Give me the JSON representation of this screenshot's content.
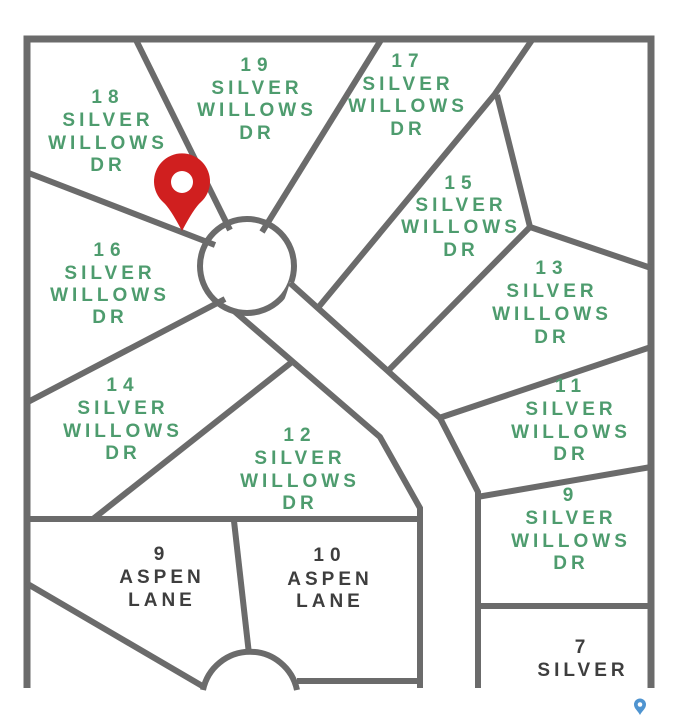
{
  "map": {
    "description_labels": {
      "street_silver_willows": "SILVER WILLOWS DR",
      "street_aspen_lane": "ASPEN LANE"
    },
    "colors": {
      "background": "#ffffff",
      "line": "#6b6b6b",
      "label_green": "#4e9c6e",
      "label_dark": "#3e3e3e",
      "pin_red": "#d01f1f",
      "pin_hole": "#ffffff",
      "mini_pin_blue": "#4f94d0"
    },
    "lots": [
      {
        "number": "18",
        "street": "SILVER WILLOWS DR",
        "lines": [
          "18",
          "SILVER",
          "WILLOWS",
          "DR"
        ]
      },
      {
        "number": "19",
        "street": "SILVER WILLOWS DR",
        "lines": [
          "19",
          "SILVER",
          "WILLOWS",
          "DR"
        ]
      },
      {
        "number": "17",
        "street": "SILVER WILLOWS DR",
        "lines": [
          "17",
          "SILVER",
          "WILLOWS",
          "DR"
        ]
      },
      {
        "number": "15",
        "street": "SILVER WILLOWS DR",
        "lines": [
          "15",
          "SILVER",
          "WILLOWS",
          "DR"
        ]
      },
      {
        "number": "13",
        "street": "SILVER WILLOWS DR",
        "lines": [
          "13",
          "SILVER",
          "WILLOWS",
          "DR"
        ]
      },
      {
        "number": "11",
        "street": "SILVER WILLOWS DR",
        "lines": [
          "11",
          "SILVER",
          "WILLOWS",
          "DR"
        ]
      },
      {
        "number": "9",
        "street": "SILVER WILLOWS DR",
        "lines": [
          "9",
          "SILVER",
          "WILLOWS",
          "DR"
        ]
      },
      {
        "number": "16",
        "street": "SILVER WILLOWS DR",
        "lines": [
          "16",
          "SILVER",
          "WILLOWS",
          "DR"
        ]
      },
      {
        "number": "14",
        "street": "SILVER WILLOWS DR",
        "lines": [
          "14",
          "SILVER",
          "WILLOWS",
          "DR"
        ]
      },
      {
        "number": "12",
        "street": "SILVER WILLOWS DR",
        "lines": [
          "12",
          "SILVER",
          "WILLOWS",
          "DR"
        ]
      },
      {
        "number": "9",
        "street": "ASPEN LANE",
        "lines": [
          "9",
          "ASPEN",
          "LANE"
        ]
      },
      {
        "number": "10",
        "street": "ASPEN LANE",
        "lines": [
          "10",
          "ASPEN",
          "LANE"
        ]
      },
      {
        "number": "7",
        "street": "SILVER",
        "lines": [
          "7",
          "SILVER"
        ]
      }
    ],
    "markers": {
      "primary_pin": {
        "name": "red-location-pin"
      },
      "small_pin": {
        "name": "blue-mini-pin"
      }
    }
  }
}
